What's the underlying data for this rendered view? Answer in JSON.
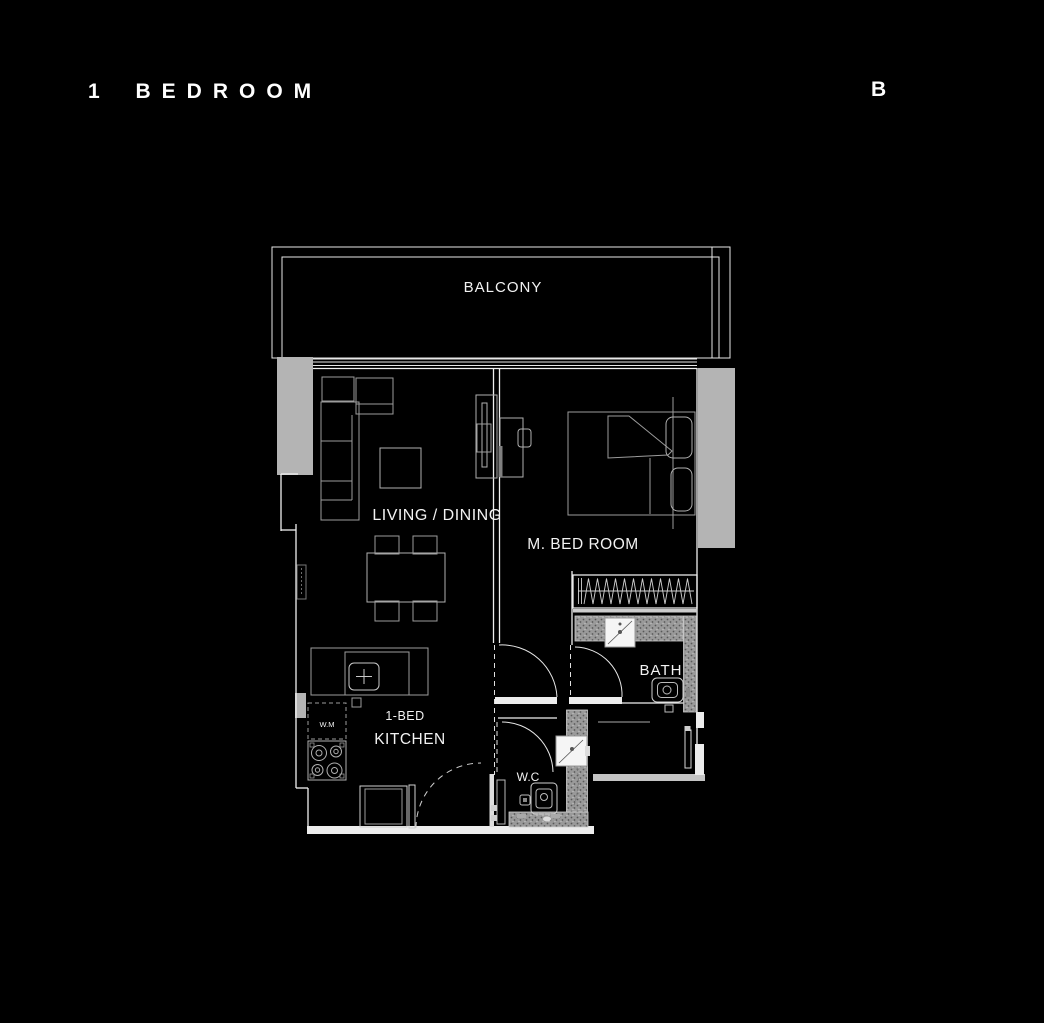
{
  "header": {
    "title": "1 BEDROOM",
    "plan_letter": "B"
  },
  "plan": {
    "labels": {
      "balcony": "BALCONY",
      "living_dining": "LIVING / DINING",
      "master_bedroom": "M. BED ROOM",
      "bath": "BATH",
      "unit_type": "1-BED",
      "kitchen": "KITCHEN",
      "wc": "W.C",
      "washing_machine": "W.M"
    },
    "colors": {
      "background": "#000000",
      "wall_line": "#f0f0f0",
      "furniture_line": "#9c9c9c",
      "block_fill": "#b4b4b4",
      "hatch_base": "#9a9a9a"
    }
  }
}
